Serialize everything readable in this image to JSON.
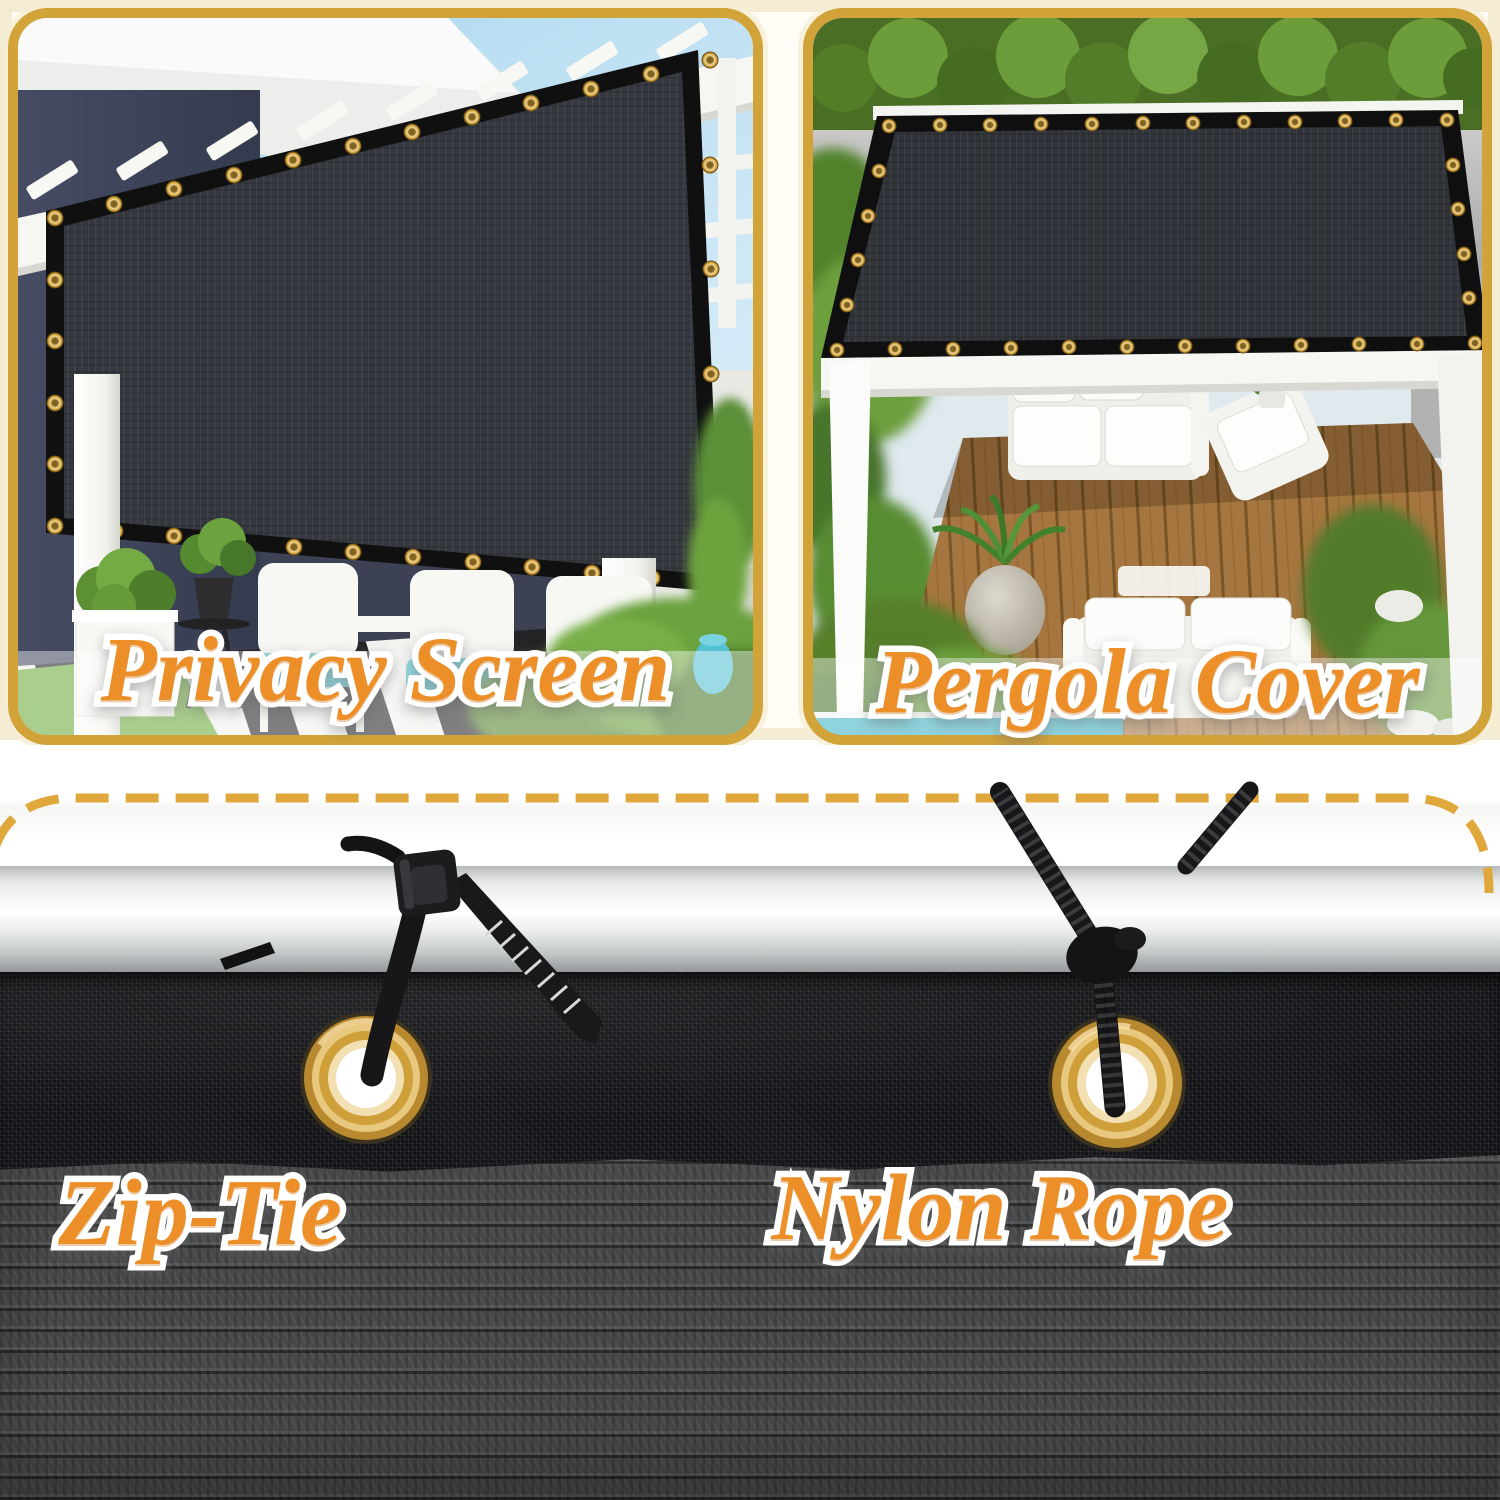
{
  "product_gallery": {
    "panels": [
      {
        "caption": "Privacy Screen"
      },
      {
        "caption": "Pergola Cover"
      }
    ],
    "hardware_labels": [
      {
        "text": "Zip-Tie"
      },
      {
        "text": "Nylon Rope"
      }
    ],
    "colors": {
      "caption_orange": "#EC8F28",
      "caption_outline": "#FFFFFF",
      "panel_border_gold": "#D2A339",
      "dashed_line_gold": "#E0A83C",
      "grommet_brass": "#D8A63F",
      "screen_mesh_charcoal": "#33363C",
      "fabric_fine_black": "#17181B",
      "fabric_weave_gray": "#46484A",
      "pole_silver": "#E9EBEB",
      "cushion_teal": "#49C3CE",
      "deck_wood_brown": "#A5763F",
      "wall_navy": "#3F4659",
      "grass_green": "#6CAB3C",
      "sky_blue": "#BFE0F1",
      "hedge_green": "#5C8A30"
    },
    "graphics": [
      {
        "name": "grommet-ring-icon"
      },
      {
        "name": "zip-tie-icon"
      },
      {
        "name": "nylon-rope-icon"
      },
      {
        "name": "dashed-divider-line"
      }
    ]
  }
}
